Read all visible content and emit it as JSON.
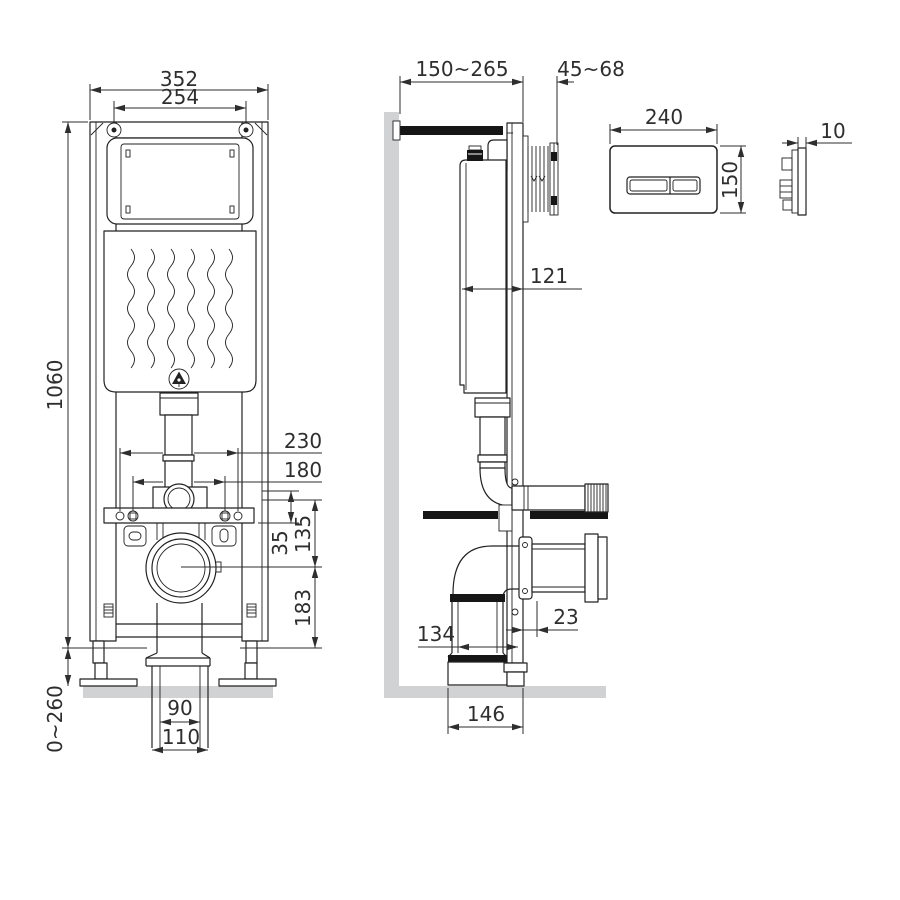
{
  "colors": {
    "line": "#222222",
    "dim_text": "#2e2e2e",
    "surface_gray": "#d0d2d4",
    "black_part": "#161616"
  },
  "front_view": {
    "dims": {
      "overall_width": "352",
      "screw_spacing": "254",
      "frame_height": "1060",
      "leg_adjust": "0~260",
      "hole_spacing_outer": "230",
      "hole_spacing_inner": "180",
      "rail_offset": "35",
      "inlet_to_outlet": "135",
      "outlet_height": "183",
      "drain_inner": "90",
      "drain_outer": "110"
    }
  },
  "side_view": {
    "dims": {
      "depth_range": "150~265",
      "shaft_range": "45~68",
      "cistern_depth": "121",
      "leg_offset": "23",
      "drain_offset": "134",
      "base_depth": "146"
    }
  },
  "flush_plate": {
    "dims": {
      "width": "240",
      "height": "150",
      "thickness": "10"
    }
  }
}
